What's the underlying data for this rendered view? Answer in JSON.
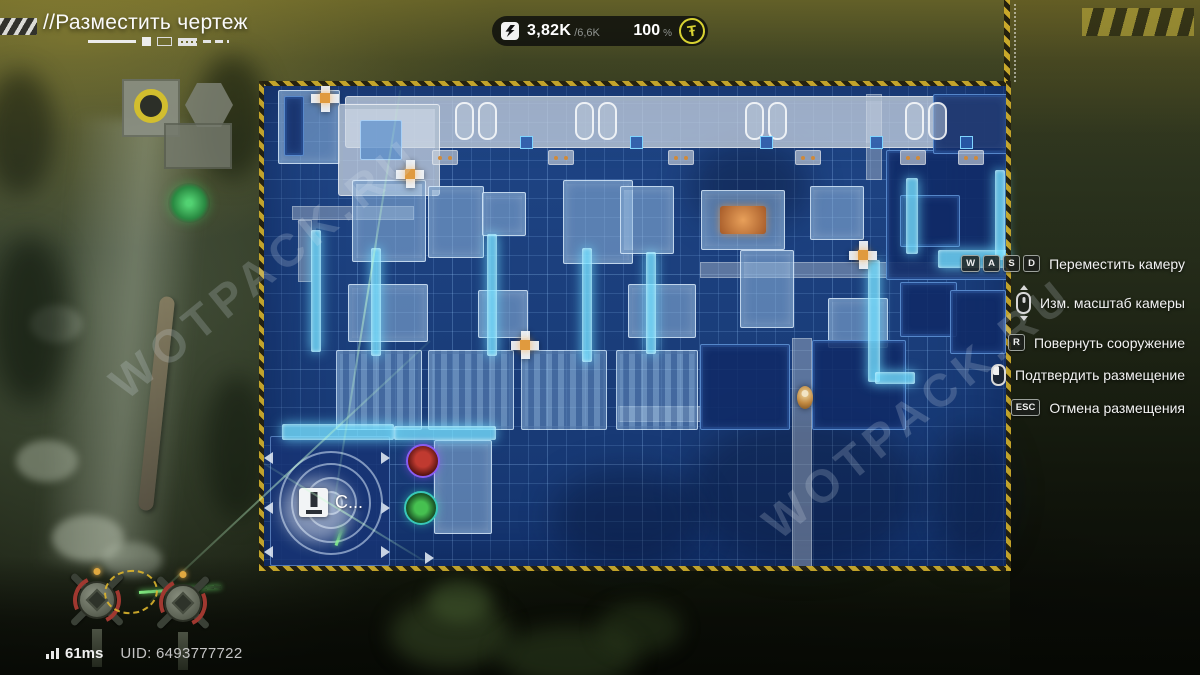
{
  "hud": {
    "title": "//Разместить чертеж",
    "resources": {
      "energy_current": "3,82K",
      "energy_max": "/6,6K",
      "percent": "100",
      "percent_sign": "%",
      "coin_glyph": "Ŧ"
    },
    "hints": [
      {
        "keys": [
          "W",
          "A",
          "S",
          "D"
        ],
        "icon": null,
        "label": "Переместить камеру"
      },
      {
        "keys": [],
        "icon": "mouse-scroll",
        "label": "Изм. масштаб камеры"
      },
      {
        "keys": [
          "R"
        ],
        "icon": null,
        "label": "Повернуть сооружение"
      },
      {
        "keys": [],
        "icon": "mouse-left",
        "label": "Подтвердить размещение"
      },
      {
        "keys": [
          "ESC"
        ],
        "icon": null,
        "label": "Отмена размещения"
      }
    ],
    "status": {
      "ping": "61ms",
      "uid": "UID: 6493777722"
    }
  },
  "watermark": {
    "text": "WOTPACK.RU"
  },
  "colors": {
    "hazard_yellow": "#c9a82a",
    "blueprint_blue": "#1c458f",
    "conveyor_cyan": "#76e0ff",
    "threat_purple": "#8a5cf0",
    "resource_teal": "#38c8b8",
    "currency_yellow": "#d8d232"
  },
  "map": {
    "core_label": "С...",
    "buildings": [
      {
        "x": 278,
        "y": 90,
        "w": 62,
        "h": 74,
        "t": "mach"
      },
      {
        "x": 284,
        "y": 96,
        "w": 20,
        "h": 60,
        "t": "dark"
      },
      {
        "x": 345,
        "y": 96,
        "w": 663,
        "h": 52,
        "t": "plat"
      },
      {
        "x": 338,
        "y": 104,
        "w": 102,
        "h": 92,
        "t": "plat"
      },
      {
        "x": 360,
        "y": 120,
        "w": 42,
        "h": 40,
        "t": "darksq"
      },
      {
        "x": 352,
        "y": 180,
        "w": 74,
        "h": 82,
        "t": "mach"
      },
      {
        "x": 428,
        "y": 186,
        "w": 56,
        "h": 72,
        "t": "mach"
      },
      {
        "x": 482,
        "y": 192,
        "w": 44,
        "h": 44,
        "t": "mach"
      },
      {
        "x": 563,
        "y": 180,
        "w": 70,
        "h": 84,
        "t": "mach"
      },
      {
        "x": 620,
        "y": 186,
        "w": 54,
        "h": 68,
        "t": "mach"
      },
      {
        "x": 701,
        "y": 190,
        "w": 84,
        "h": 60,
        "t": "machO"
      },
      {
        "x": 810,
        "y": 186,
        "w": 54,
        "h": 54,
        "t": "mach"
      },
      {
        "x": 886,
        "y": 150,
        "w": 122,
        "h": 130,
        "t": "dark"
      },
      {
        "x": 900,
        "y": 195,
        "w": 60,
        "h": 52,
        "t": "dark"
      },
      {
        "x": 933,
        "y": 94,
        "w": 75,
        "h": 60,
        "t": "dark"
      },
      {
        "x": 348,
        "y": 284,
        "w": 80,
        "h": 58,
        "t": "mach"
      },
      {
        "x": 478,
        "y": 290,
        "w": 50,
        "h": 48,
        "t": "mach"
      },
      {
        "x": 628,
        "y": 284,
        "w": 68,
        "h": 54,
        "t": "mach"
      },
      {
        "x": 740,
        "y": 250,
        "w": 54,
        "h": 78,
        "t": "mach"
      },
      {
        "x": 828,
        "y": 298,
        "w": 60,
        "h": 50,
        "t": "mach"
      },
      {
        "x": 900,
        "y": 282,
        "w": 57,
        "h": 55,
        "t": "dark"
      },
      {
        "x": 950,
        "y": 290,
        "w": 56,
        "h": 64,
        "t": "dark"
      },
      {
        "x": 336,
        "y": 350,
        "w": 86,
        "h": 80,
        "t": "furn"
      },
      {
        "x": 428,
        "y": 350,
        "w": 86,
        "h": 80,
        "t": "furn"
      },
      {
        "x": 521,
        "y": 350,
        "w": 86,
        "h": 80,
        "t": "furn"
      },
      {
        "x": 616,
        "y": 350,
        "w": 82,
        "h": 80,
        "t": "furn"
      },
      {
        "x": 700,
        "y": 344,
        "w": 90,
        "h": 86,
        "t": "dark"
      },
      {
        "x": 812,
        "y": 340,
        "w": 94,
        "h": 90,
        "t": "dark"
      },
      {
        "x": 270,
        "y": 436,
        "w": 120,
        "h": 130,
        "t": "darkb"
      },
      {
        "x": 434,
        "y": 440,
        "w": 58,
        "h": 94,
        "t": "mach"
      }
    ],
    "strip_panels": [
      455,
      575,
      745,
      905
    ],
    "junctions": [
      520,
      630,
      760,
      870,
      960
    ],
    "pads": [
      432,
      548,
      668,
      795,
      900,
      958
    ],
    "conveyors": [
      {
        "x": 311,
        "y": 230,
        "w": 10,
        "h": 122
      },
      {
        "x": 371,
        "y": 248,
        "w": 10,
        "h": 108
      },
      {
        "x": 487,
        "y": 234,
        "w": 10,
        "h": 122
      },
      {
        "x": 582,
        "y": 248,
        "w": 10,
        "h": 114
      },
      {
        "x": 646,
        "y": 252,
        "w": 10,
        "h": 102
      },
      {
        "x": 282,
        "y": 424,
        "w": 112,
        "h": 16
      },
      {
        "x": 394,
        "y": 426,
        "w": 102,
        "h": 14
      },
      {
        "x": 938,
        "y": 250,
        "w": 70,
        "h": 18
      },
      {
        "x": 906,
        "y": 178,
        "w": 12,
        "h": 76
      },
      {
        "x": 868,
        "y": 260,
        "w": 12,
        "h": 122
      },
      {
        "x": 875,
        "y": 372,
        "w": 40,
        "h": 12
      },
      {
        "x": 995,
        "y": 170,
        "w": 10,
        "h": 90
      }
    ],
    "paths": [
      {
        "x": 792,
        "y": 338,
        "w": 20,
        "h": 230
      },
      {
        "x": 700,
        "y": 262,
        "w": 308,
        "h": 16
      },
      {
        "x": 866,
        "y": 94,
        "w": 16,
        "h": 86
      },
      {
        "x": 618,
        "y": 406,
        "w": 84,
        "h": 16
      },
      {
        "x": 292,
        "y": 206,
        "w": 122,
        "h": 14
      },
      {
        "x": 298,
        "y": 220,
        "w": 14,
        "h": 62
      }
    ],
    "poles": [
      [
        325,
        98
      ],
      [
        410,
        174
      ],
      [
        525,
        345
      ],
      [
        863,
        255
      ]
    ],
    "triangles": [
      {
        "x": 264,
        "y": 452,
        "d": "l"
      },
      {
        "x": 264,
        "y": 502,
        "d": "l"
      },
      {
        "x": 264,
        "y": 546,
        "d": "l"
      },
      {
        "x": 381,
        "y": 452,
        "d": "r"
      },
      {
        "x": 381,
        "y": 502,
        "d": "r"
      },
      {
        "x": 381,
        "y": 546,
        "d": "r"
      },
      {
        "x": 425,
        "y": 552,
        "d": "r"
      }
    ],
    "clouds": [
      {
        "x": 688,
        "y": 414,
        "w": 232,
        "h": 152
      },
      {
        "x": 552,
        "y": 468,
        "w": 150,
        "h": 100
      },
      {
        "x": 930,
        "y": 428,
        "w": 80,
        "h": 132
      },
      {
        "x": 690,
        "y": 140,
        "w": 120,
        "h": 90
      }
    ],
    "lasers": [
      {
        "x": 150,
        "y": 601,
        "len": 383,
        "ang": -43,
        "b": 0
      },
      {
        "x": 263,
        "y": 462,
        "len": 189,
        "ang": 31.3,
        "b": 0
      },
      {
        "x": 139,
        "y": 591,
        "len": 82,
        "ang": -4,
        "b": 1
      },
      {
        "x": 336,
        "y": 544,
        "len": 20,
        "ang": -70,
        "b": 1
      },
      {
        "x": 334,
        "y": 503,
        "len": 419,
        "ang": -80.9,
        "b": 0
      }
    ]
  }
}
